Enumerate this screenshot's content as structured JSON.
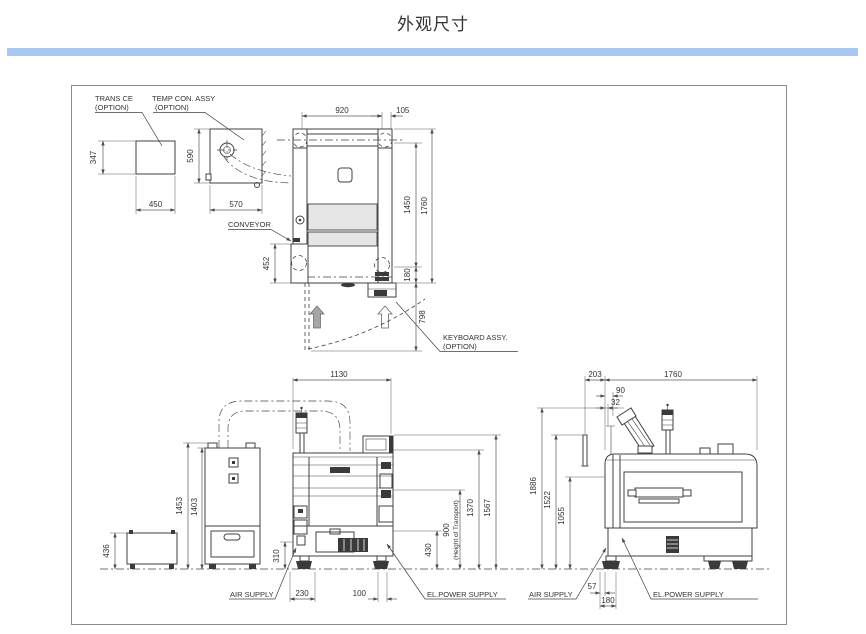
{
  "page": {
    "title": "外观尺寸"
  },
  "colors": {
    "accent_bar": "#a9c8f1",
    "line": "#424242",
    "dim_line": "#5a5a5a",
    "text": "#333333",
    "fill_light": "#e6e6e6",
    "fill_dark": "#3a3a3a",
    "arrow_gray": "#a6a6a6"
  },
  "labels": {
    "trans_line1": "TRANS CE",
    "trans_line2": "(OPTION)",
    "temp_line1": "TEMP CON. ASSY",
    "temp_line2": "(OPTION)",
    "conveyor": "CONVEYOR",
    "keyboard_line1": "KEYBOARD ASSY.",
    "keyboard_line2": "(OPTION)",
    "air_front": "AIR SUPPLY",
    "el_front": "EL.POWER SUPPLY",
    "air_side": "AIR SUPPLY",
    "el_side": "EL.POWER SUPPLY"
  },
  "dims": {
    "plan": {
      "d920": "920",
      "d105": "105",
      "d1450": "1450",
      "d1760": "1760",
      "d452": "452",
      "d180": "180",
      "d798": "798",
      "d450": "450",
      "d347": "347",
      "d570": "570",
      "d590": "590"
    },
    "front": {
      "d1130": "1130",
      "d1453": "1453",
      "d1403": "1403",
      "d436": "436",
      "d310": "310",
      "d230": "230",
      "d100": "100",
      "d430": "430",
      "d900": "900",
      "d900n": "(Height of Transport)",
      "d1370": "1370",
      "d1567": "1567"
    },
    "side": {
      "d203": "203",
      "d1760": "1760",
      "d90": "90",
      "d32": "32",
      "d1886": "1886",
      "d1522": "1522",
      "d1055": "1055",
      "d57": "57",
      "d180": "180"
    }
  }
}
